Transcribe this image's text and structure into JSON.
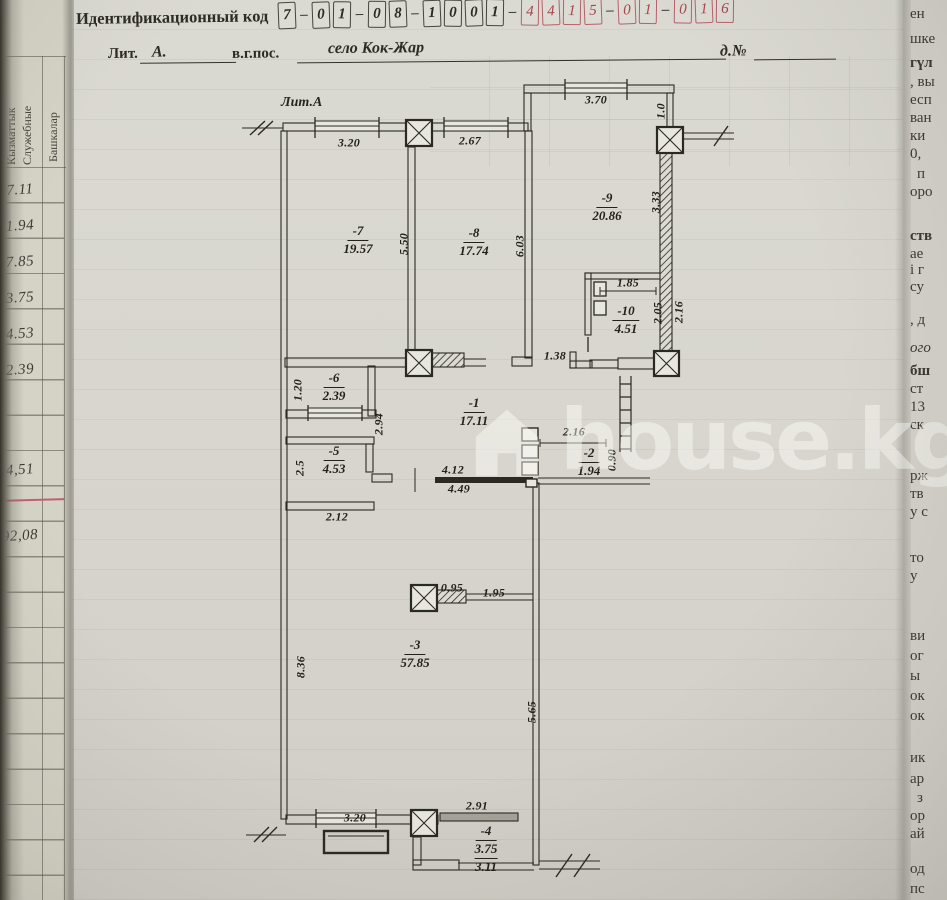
{
  "header": {
    "code_label": "Идентификационный код",
    "dash": "–"
  },
  "id_code": {
    "g1": [
      "7"
    ],
    "g2": [
      "0",
      "1"
    ],
    "g3": [
      "0",
      "8"
    ],
    "g4": [
      "1",
      "0",
      "0",
      "1"
    ],
    "g5": [
      "4",
      "4",
      "1",
      "5"
    ],
    "g6": [
      "0",
      "1"
    ],
    "g7": [
      "0",
      "1",
      "6"
    ]
  },
  "address": {
    "lit_label": "Лит.",
    "lit_value": "А.",
    "prefix": "в.г.пос.",
    "settlement": "село Кок-Жар",
    "house_label": "д.№"
  },
  "plan": {
    "lit": "Лит.А",
    "rooms": {
      "r1": {
        "num": "-1",
        "area": "17.11"
      },
      "r2": {
        "num": "-2",
        "area": "1.94"
      },
      "r3": {
        "num": "-3",
        "area": "57.85"
      },
      "r4": {
        "num": "-4",
        "area": "3.75",
        "area2": "3.11"
      },
      "r5": {
        "num": "-5",
        "area": "4.53"
      },
      "r6": {
        "num": "-6",
        "area": "2.39"
      },
      "r7": {
        "num": "-7",
        "area": "19.57"
      },
      "r8": {
        "num": "-8",
        "area": "17.74"
      },
      "r9": {
        "num": "-9",
        "area": "20.86"
      },
      "r10": {
        "num": "-10",
        "area": "4.51"
      }
    },
    "dims": {
      "top_w1": "3.20",
      "top_w2": "2.67",
      "top_w3": "3.70",
      "top_right_h": "1.0",
      "h_550": "5.50",
      "h_603": "6.03",
      "h_333": "3.33",
      "w_185": "1.85",
      "h_205": "2.05",
      "h_216": "2.16",
      "w_138": "1.38",
      "h_120": "1.20",
      "h_294": "2.94",
      "h_25": "2.5",
      "w_212": "2.12",
      "w_412": "4.12",
      "w_449": "4.49",
      "w_216_2": "2.16",
      "h_090": "0.90",
      "w_095": "0.95",
      "w_195": "1.95",
      "h_836": "8.36",
      "h_565": "5.65",
      "bot_w1": "3.20",
      "bot_w2": "2.91"
    }
  },
  "watermark": {
    "text": "house.kg"
  },
  "left_table": {
    "header_col1_line1": "Кызматтык",
    "header_col1_line2": "Служебные",
    "header_col2": "Башкалар",
    "values": [
      "7.11",
      "1.94",
      "7.85",
      "3.75",
      "4.53",
      "2.39",
      "4,51",
      "92,08"
    ]
  },
  "right_strip": {
    "fragments": [
      "ен",
      "шке",
      "гүл",
      ", вы",
      "есп",
      "ван",
      "ки",
      "0,",
      "п",
      "оро",
      "ств",
      "ае",
      "і г",
      "су",
      ", д",
      "ого",
      "бш",
      "ст",
      "13",
      "ск",
      "рж",
      "тв",
      "у с",
      "то",
      "у",
      "ви",
      "ог",
      "ы",
      "ок",
      "ок",
      "ик",
      "ар",
      "з",
      "ор",
      "ай",
      "од",
      "пс"
    ]
  }
}
